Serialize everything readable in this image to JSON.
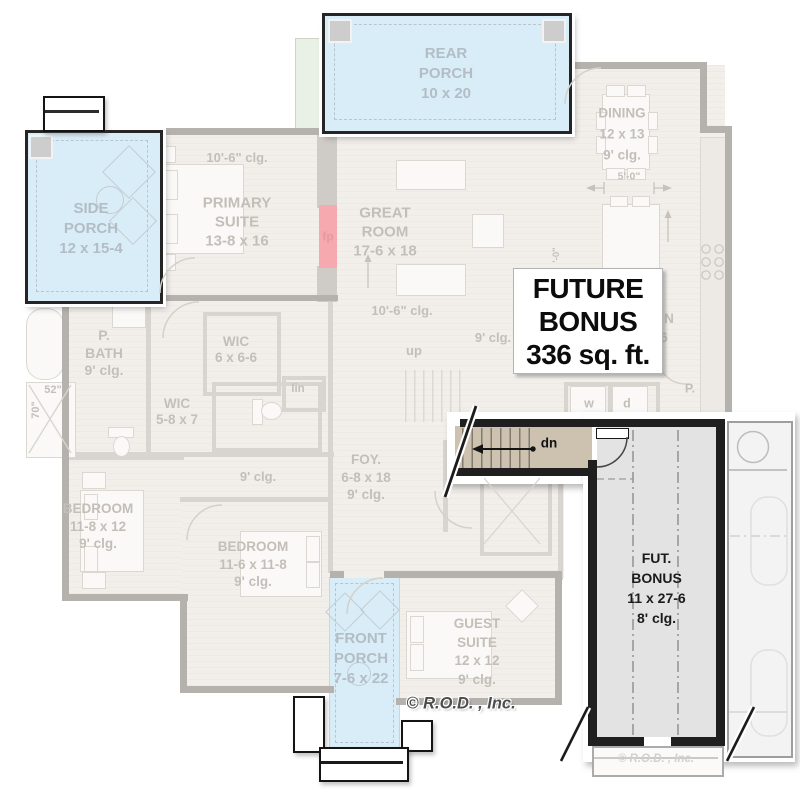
{
  "plan": {
    "future_box": {
      "line1": "FUTURE",
      "line2": "BONUS",
      "line3": "336 sq. ft."
    },
    "bonus_room": {
      "line1": "FUT.",
      "line2": "BONUS",
      "line3": "11 x 27-6",
      "line4": "8' clg."
    },
    "stair": {
      "down_label": "dn"
    },
    "copyright": "© R.O.D. , Inc.",
    "copyright_faint": "© R.O.D. , Inc."
  },
  "colors": {
    "porch_fill": "#d9edf8",
    "stair_fill": "#cdc2b0",
    "bonus_fill": "#e3e3e3",
    "bold_wall": "#1f1f1f",
    "faded_wall": "#b5b2ad",
    "fireplace": "#f6a9ae",
    "green_strip": "#e9f0e5"
  },
  "labels": [
    {
      "id": "rear-porch-label",
      "cls": "porch-t",
      "x": 446,
      "y": 74,
      "fs": 15,
      "lh": 20,
      "lines": [
        "REAR",
        "PORCH",
        "10 x 20"
      ]
    },
    {
      "id": "side-porch-label",
      "cls": "porch-t",
      "x": 91,
      "y": 229,
      "fs": 15,
      "lh": 20,
      "lines": [
        "SIDE",
        "PORCH",
        "12 x 15-4"
      ]
    },
    {
      "id": "front-porch-label",
      "cls": "porch-t",
      "x": 361,
      "y": 659,
      "fs": 15,
      "lh": 20,
      "lines": [
        "FRONT",
        "PORCH",
        "7-6 x 22"
      ]
    },
    {
      "id": "primary-ceiling-label",
      "x": 237,
      "y": 158,
      "fs": 13,
      "lh": 14,
      "lines": [
        "10'-6\" clg."
      ]
    },
    {
      "id": "primary-suite-label",
      "x": 237,
      "y": 222,
      "fs": 15,
      "lh": 19,
      "lines": [
        "PRIMARY",
        "SUITE",
        "13-8 x 16"
      ]
    },
    {
      "id": "great-room-label",
      "x": 385,
      "y": 232,
      "fs": 15,
      "lh": 19,
      "lines": [
        "GREAT",
        "ROOM",
        "17-6 x 18"
      ]
    },
    {
      "id": "great-ceiling-label",
      "x": 402,
      "y": 311,
      "fs": 13,
      "lh": 14,
      "lines": [
        "10'-6\" clg."
      ]
    },
    {
      "id": "dining-label",
      "x": 622,
      "y": 134,
      "fs": 13.5,
      "lh": 21,
      "lines": [
        "DINING",
        "12 x 13",
        "9' clg."
      ]
    },
    {
      "id": "dining-dim-label",
      "x": 629,
      "y": 177,
      "fs": 10.5,
      "lh": 11,
      "lines": [
        "5'-0\""
      ]
    },
    {
      "id": "fireplace-label",
      "cls": "pink",
      "x": 328,
      "y": 237,
      "fs": 12,
      "lh": 13,
      "lines": [
        "fp"
      ]
    },
    {
      "id": "primary-bath-label",
      "x": 104,
      "y": 353,
      "fs": 14,
      "lh": 17.5,
      "lines": [
        "P.",
        "BATH",
        "9' clg."
      ]
    },
    {
      "id": "shower-dim-label",
      "x": 53,
      "y": 390,
      "fs": 11,
      "lh": 12,
      "lines": [
        "52\""
      ]
    },
    {
      "id": "shower-dim2-label",
      "x": 36,
      "y": 410,
      "fs": 11,
      "lh": 12,
      "rot": -90,
      "lines": [
        "70\""
      ]
    },
    {
      "id": "wic1-label",
      "x": 236,
      "y": 350,
      "fs": 13.5,
      "lh": 16,
      "lines": [
        "WIC",
        "6 x 6-6"
      ]
    },
    {
      "id": "wic2-label",
      "x": 177,
      "y": 412,
      "fs": 13.5,
      "lh": 16,
      "lines": [
        "WIC",
        "5-8 x 7"
      ]
    },
    {
      "id": "linen-label",
      "x": 298,
      "y": 389,
      "fs": 11.5,
      "lh": 12,
      "lines": [
        "lin"
      ]
    },
    {
      "id": "hall-ceiling-label",
      "x": 258,
      "y": 477,
      "fs": 13,
      "lh": 14,
      "lines": [
        "9' clg."
      ]
    },
    {
      "id": "mid-ceiling-label",
      "x": 493,
      "y": 338,
      "fs": 13,
      "lh": 14,
      "lines": [
        "9' clg."
      ]
    },
    {
      "id": "up-label",
      "x": 414,
      "y": 351,
      "fs": 13,
      "lh": 14,
      "lines": [
        "up"
      ]
    },
    {
      "id": "foyer-label",
      "x": 366,
      "y": 477,
      "fs": 13.5,
      "lh": 17.5,
      "lines": [
        "FOY.",
        "6-8 x 18",
        "9' clg."
      ]
    },
    {
      "id": "bedroom1-label",
      "x": 98,
      "y": 526,
      "fs": 13.5,
      "lh": 17.5,
      "lines": [
        "BEDROOM",
        "11-8 x 12",
        "9' clg."
      ]
    },
    {
      "id": "bedroom2-label",
      "x": 253,
      "y": 564,
      "fs": 13.5,
      "lh": 17.5,
      "lines": [
        "BEDROOM",
        "11-6 x 11-8",
        "9' clg."
      ]
    },
    {
      "id": "guest-suite-label",
      "x": 477,
      "y": 652,
      "fs": 13.5,
      "lh": 18.5,
      "lines": [
        "GUEST",
        "SUITE",
        "12 x 12",
        "9' clg."
      ]
    },
    {
      "id": "kitchen-fragment-n",
      "x": 669,
      "y": 319,
      "fs": 13.5,
      "lh": 14,
      "lines": [
        "N"
      ]
    },
    {
      "id": "kitchen-fragment-6",
      "x": 664,
      "y": 338,
      "fs": 13.5,
      "lh": 14,
      "lines": [
        "6"
      ]
    },
    {
      "id": "pantry-label",
      "x": 690,
      "y": 389,
      "fs": 12.5,
      "lh": 13,
      "lines": [
        "P."
      ]
    },
    {
      "id": "washer-label",
      "x": 589,
      "y": 404,
      "fs": 12.5,
      "lh": 13,
      "lines": [
        "w"
      ]
    },
    {
      "id": "dryer-label",
      "x": 627,
      "y": 404,
      "fs": 12.5,
      "lh": 13,
      "lines": [
        "d"
      ]
    },
    {
      "id": "island-dim-label",
      "x": 557,
      "y": 255,
      "fs": 9.5,
      "lh": 10,
      "rot": -90,
      "lines": [
        "'-0\""
      ]
    }
  ]
}
